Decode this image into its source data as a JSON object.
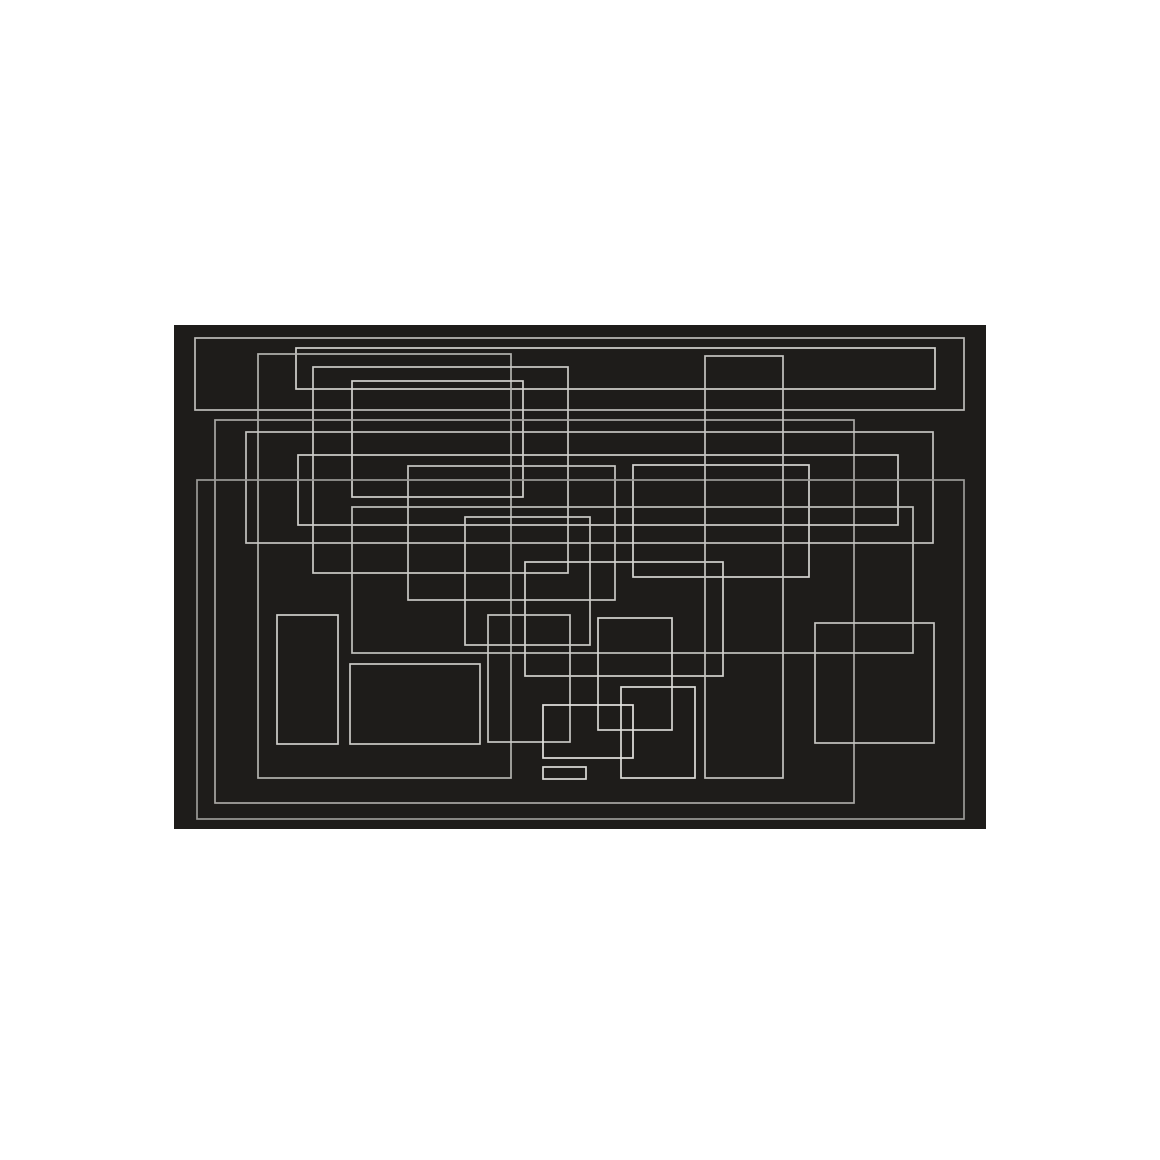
{
  "page": {
    "background_color": "#ffffff",
    "width": 1160,
    "height": 1160
  },
  "artwork": {
    "type": "abstract-rectangle-composition",
    "description": "overlapping thin light-gray rectangle outlines on a dark canvas",
    "canvas": {
      "x": 174,
      "y": 325,
      "width": 812,
      "height": 504,
      "fill": "#1e1c1a"
    },
    "default_stroke": "#c6c5c2",
    "stroke_width": 1.7,
    "rectangles": [
      {
        "name": "wide-top-frame",
        "x": 195,
        "y": 338,
        "w": 769,
        "h": 72,
        "stroke": "#bdbcb9"
      },
      {
        "name": "long-top-bar",
        "x": 296,
        "y": 348,
        "w": 639,
        "h": 41,
        "stroke": "#d2d1ce"
      },
      {
        "name": "tall-left-frame",
        "x": 258,
        "y": 354,
        "w": 253,
        "h": 424,
        "stroke": "#b3b2af"
      },
      {
        "name": "mid-left-frame",
        "x": 313,
        "y": 367,
        "w": 255,
        "h": 206,
        "stroke": "#cbcac7"
      },
      {
        "name": "small-upper-left-box",
        "x": 352,
        "y": 381,
        "w": 171,
        "h": 116,
        "stroke": "#d2d1ce"
      },
      {
        "name": "large-inner-frame",
        "x": 215,
        "y": 420,
        "w": 639,
        "h": 383,
        "stroke": "#a8a7a4"
      },
      {
        "name": "wide-middle-band",
        "x": 246,
        "y": 432,
        "w": 687,
        "h": 111,
        "stroke": "#c4c3c0"
      },
      {
        "name": "long-middle-bar",
        "x": 298,
        "y": 455,
        "w": 600,
        "h": 70,
        "stroke": "#cfcecb"
      },
      {
        "name": "center-right-box",
        "x": 633,
        "y": 465,
        "w": 176,
        "h": 112,
        "stroke": "#d6d5d2"
      },
      {
        "name": "center-box",
        "x": 408,
        "y": 466,
        "w": 207,
        "h": 134,
        "stroke": "#c8c7c4"
      },
      {
        "name": "large-outer-frame",
        "x": 197,
        "y": 480,
        "w": 767,
        "h": 339,
        "stroke": "#9b9a97"
      },
      {
        "name": "wide-lower-band",
        "x": 352,
        "y": 507,
        "w": 561,
        "h": 146,
        "stroke": "#c1c0bd"
      },
      {
        "name": "small-center-box",
        "x": 465,
        "y": 517,
        "w": 125,
        "h": 128,
        "stroke": "#cbcac7"
      },
      {
        "name": "center-low-box",
        "x": 525,
        "y": 562,
        "w": 198,
        "h": 114,
        "stroke": "#d2d1ce"
      },
      {
        "name": "tall-center-right-frame",
        "x": 705,
        "y": 356,
        "w": 78,
        "h": 422,
        "stroke": "#c4c3c0"
      },
      {
        "name": "tall-bottom-left-box",
        "x": 277,
        "y": 615,
        "w": 61,
        "h": 129,
        "stroke": "#cfcecb"
      },
      {
        "name": "bottom-left-box",
        "x": 350,
        "y": 664,
        "w": 130,
        "h": 80,
        "stroke": "#cbcac7"
      },
      {
        "name": "narrow-bottom-box",
        "x": 488,
        "y": 615,
        "w": 82,
        "h": 127,
        "stroke": "#c8c7c4"
      },
      {
        "name": "small-bottom-center-box",
        "x": 598,
        "y": 618,
        "w": 74,
        "h": 112,
        "stroke": "#d6d5d2"
      },
      {
        "name": "small-bottom-box",
        "x": 621,
        "y": 687,
        "w": 74,
        "h": 91,
        "stroke": "#dddcd9"
      },
      {
        "name": "bright-bottom-box",
        "x": 543,
        "y": 705,
        "w": 90,
        "h": 53,
        "stroke": "#e3e2df"
      },
      {
        "name": "tiny-bottom-bar",
        "x": 543,
        "y": 767,
        "w": 43,
        "h": 12,
        "stroke": "#dddcd9"
      },
      {
        "name": "bottom-right-box",
        "x": 815,
        "y": 623,
        "w": 119,
        "h": 120,
        "stroke": "#c4c3c0"
      }
    ]
  }
}
